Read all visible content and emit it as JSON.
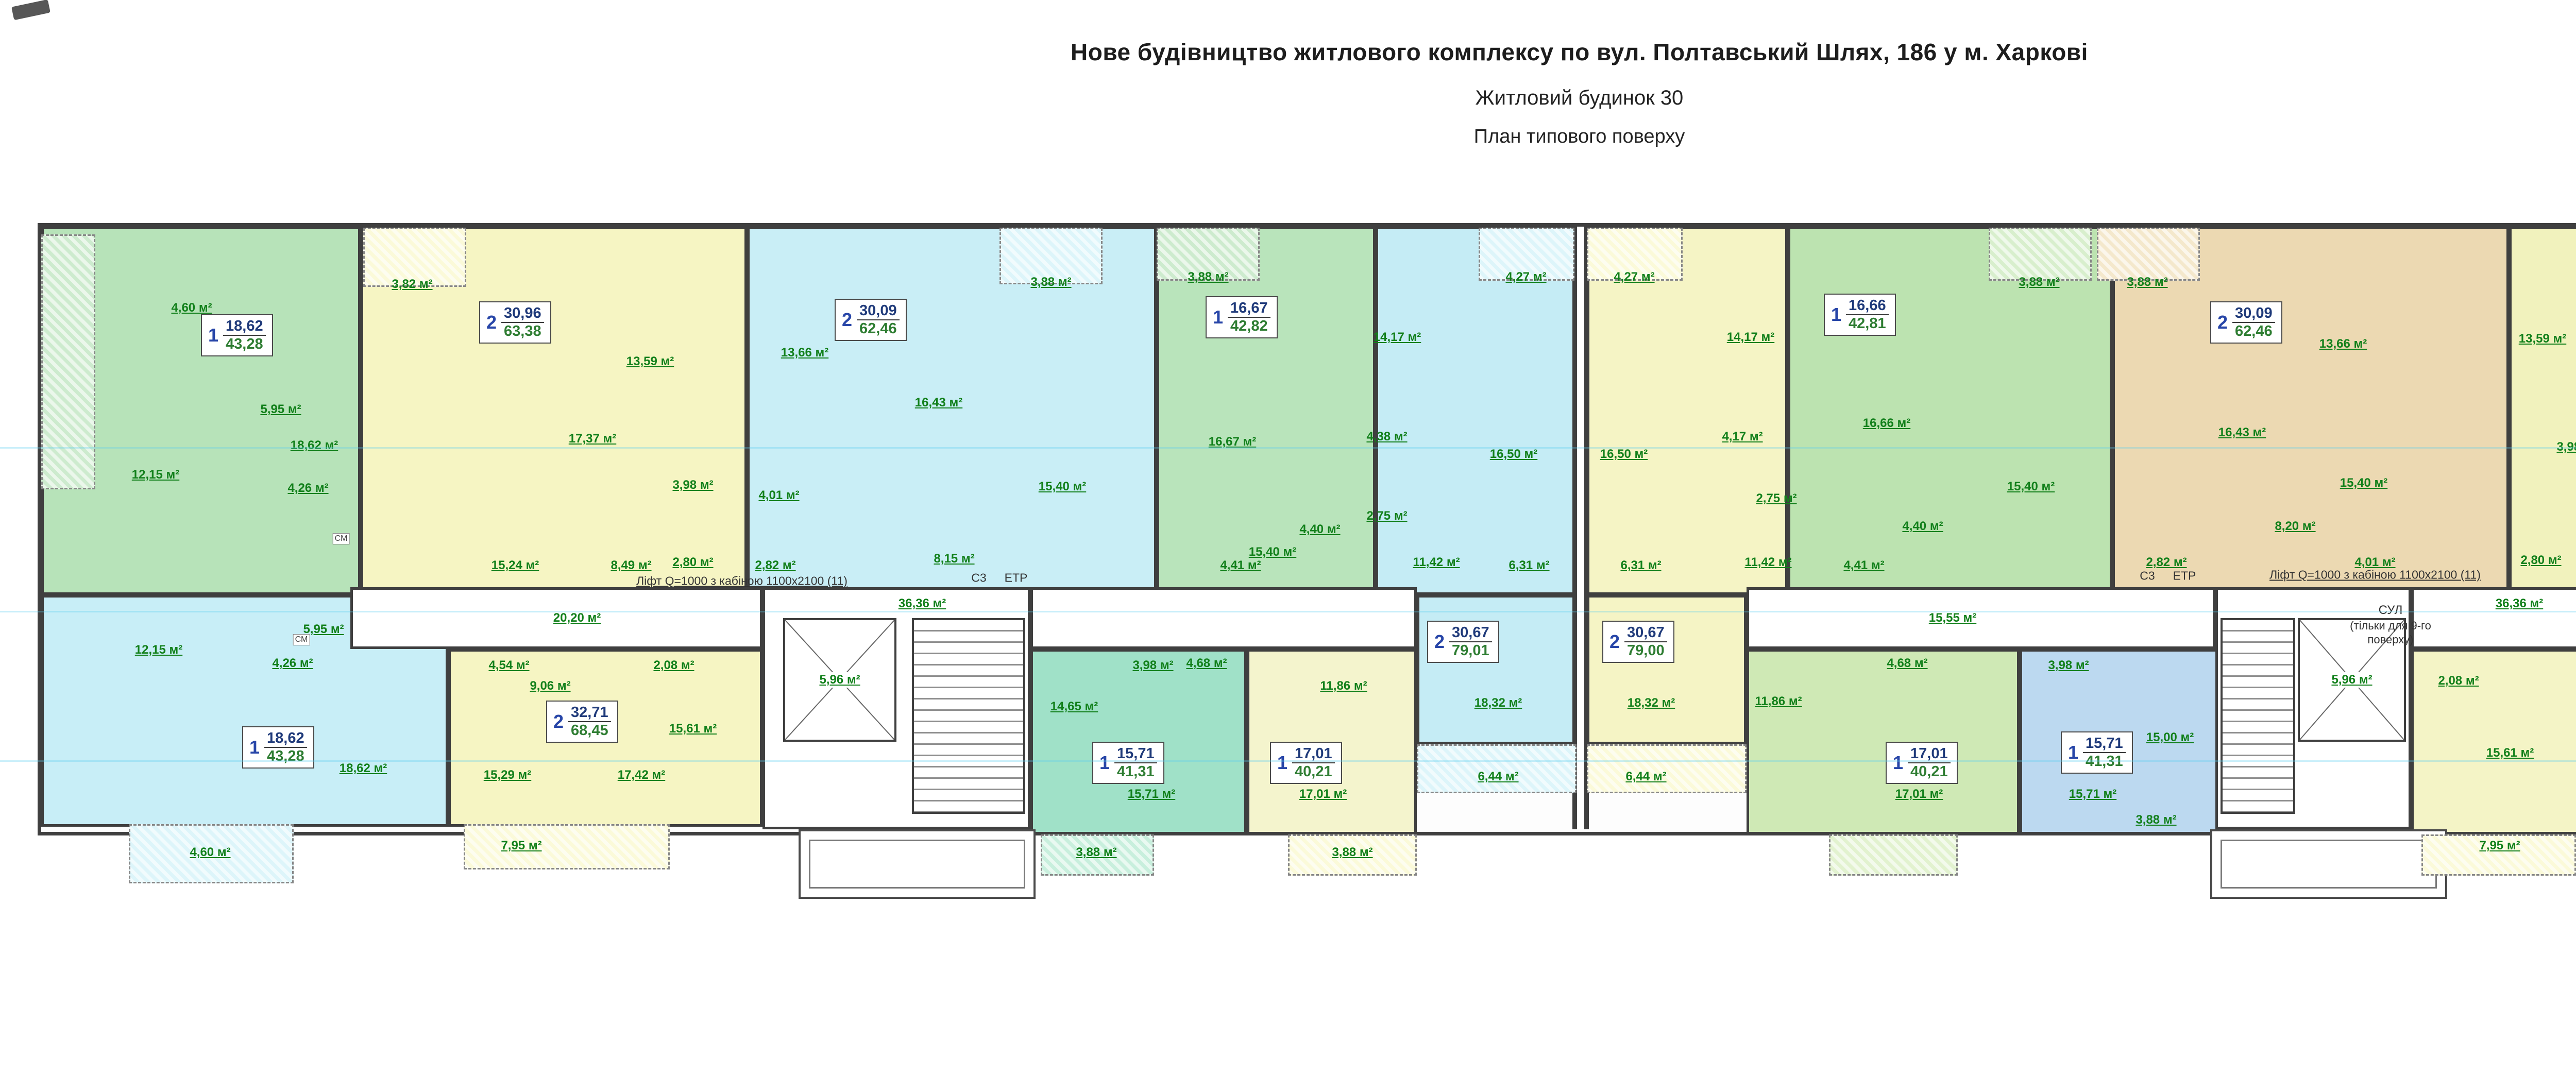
{
  "title": {
    "line1": "Нове будівництво житлового комплексу по вул. Полтавський Шлях, 186 у м. Харкові",
    "line2": "Житловий будинок 30",
    "line3": "План типового поверху"
  },
  "notes": {
    "lift": "Ліфт Q=1000 з кабіною 1100х2100  (11)",
    "c3": "С3",
    "etp": "ЕТР",
    "sul1": "СУЛ",
    "sul2": "(тільки для 9-го",
    "sul3": "поверху)",
    "cm": "СМ"
  },
  "corridors": {
    "left_wing": "20,20 м²",
    "left_main": "36,36 м²",
    "lift_shaft_left": "5,96 м²",
    "right_wing_west": "15,55 м²",
    "right_main": "36,36 м²",
    "right_wing_east": "16,43 м²",
    "lift_shaft_right": "5,96 м²"
  },
  "apartments": [
    {
      "type": "1",
      "living": "18,62",
      "total": "43,28",
      "rooms": [
        "18,62 м²",
        "12,15 м²",
        "5,95 м²",
        "4,26 м²",
        "4,60 м²"
      ]
    },
    {
      "type": "2",
      "living": "30,96",
      "total": "63,38",
      "rooms": [
        "17,37 м²",
        "13,59 м²",
        "15,24 м²",
        "8,49 м²",
        "3,98 м²",
        "2,80 м²",
        "3,82 м²"
      ]
    },
    {
      "type": "2",
      "living": "30,09",
      "total": "62,46",
      "rooms": [
        "13,66 м²",
        "16,43 м²",
        "8,15 м²",
        "15,40 м²",
        "4,01 м²",
        "2,82 м²",
        "3,88 м²"
      ]
    },
    {
      "type": "1",
      "living": "16,67",
      "total": "42,82",
      "rooms": [
        "16,67 м²",
        "15,40 м²",
        "4,40 м²",
        "4,41 м²",
        "3,88 м²"
      ]
    },
    {
      "type": "2",
      "living": "30,67",
      "total": "79,01",
      "rooms": [
        "14,17 м²",
        "16,50 м²",
        "4,38 м²",
        "2,75 м²",
        "11,42 м²",
        "6,31 м²",
        "18,32 м²",
        "6,44 м²",
        "4,27 м²"
      ]
    },
    {
      "type": "1",
      "living": "18,62",
      "total": "43,28",
      "rooms": [
        "18,62 м²",
        "12,15 м²",
        "5,95 м²",
        "4,26 м²",
        "4,60 м²"
      ]
    },
    {
      "type": "2",
      "living": "32,71",
      "total": "68,45",
      "rooms": [
        "15,29 м²",
        "17,42 м²",
        "15,61 м²",
        "9,06 м²",
        "4,54 м²",
        "2,08 м²",
        "7,95 м²"
      ]
    },
    {
      "type": "1",
      "living": "15,71",
      "total": "41,31",
      "rooms": [
        "15,71 м²",
        "14,65 м²",
        "3,98 м²",
        "4,68 м²",
        "3,88 м²"
      ]
    },
    {
      "type": "1",
      "living": "17,01",
      "total": "40,21",
      "rooms": [
        "17,01 м²",
        "11,86 м²",
        "3,88 м²"
      ]
    },
    {
      "type": "2",
      "living": "30,67",
      "total": "79,00",
      "rooms": [
        "14,17 м²",
        "16,50 м²",
        "4,17 м²",
        "2,75 м²",
        "11,42 м²",
        "6,31 м²",
        "18,32 м²",
        "6,44 м²",
        "4,27 м²"
      ]
    },
    {
      "type": "1",
      "living": "16,66",
      "total": "42,81",
      "rooms": [
        "16,66 м²",
        "15,40 м²",
        "4,40 м²",
        "4,41 м²",
        "3,88 м²"
      ]
    },
    {
      "type": "2",
      "living": "30,09",
      "total": "62,46",
      "rooms": [
        "13,66 м²",
        "16,43 м²",
        "8,20 м²",
        "15,40 м²",
        "4,01 м²",
        "2,82 м²",
        "3,88 м²"
      ]
    },
    {
      "type": "2",
      "living": "30,70",
      "total": "63,19",
      "rooms": [
        "13,59 м²",
        "17,11 м²",
        "15,44 м²",
        "8,41 м²",
        "3,98 м²",
        "2,80 м²",
        "3,71 м²"
      ]
    },
    {
      "type": "3",
      "living": "47,25",
      "total": "84,56",
      "rooms": [
        "14,10 м²",
        "15,45 м²",
        "17,70 м²",
        "12,21 м²",
        "10,07 м²",
        "4,29 м²",
        "4,14 м²",
        "2,72 м²",
        "3,88 м²",
        "3,88 м²"
      ]
    },
    {
      "type": "1",
      "living": "17,01",
      "total": "40,21",
      "rooms": [
        "17,01 м²",
        "11,86 м²",
        "4,68 м²"
      ]
    },
    {
      "type": "1",
      "living": "15,71",
      "total": "41,31",
      "rooms": [
        "15,71 м²",
        "15,00 м²",
        "3,98 м²",
        "3,88 м²"
      ]
    },
    {
      "type": "2",
      "living": "32,20",
      "total": "68,24",
      "rooms": [
        "15,61 м²",
        "17,42 м²",
        "14,77 м²",
        "9,53 м²",
        "2,08 м²",
        "7,95 м²"
      ]
    }
  ]
}
